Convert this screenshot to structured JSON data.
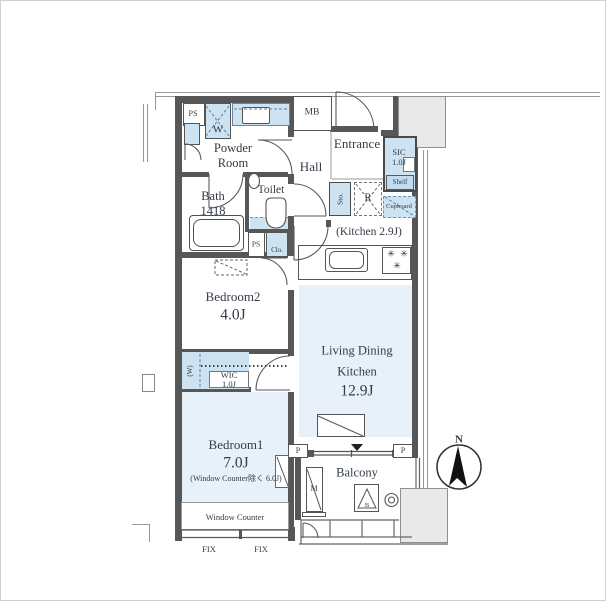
{
  "plan": {
    "compass": "N",
    "labels": {
      "ps_top": "PS",
      "washer": "W",
      "powder_room": "Powder Room",
      "meter_box": "MB",
      "entrance": "Entrance",
      "sic": "SIC 1.0J",
      "shelf": "Shelf",
      "cupboard": "Cupboard",
      "hall": "Hall",
      "storage": "Sto.",
      "fridge": "R",
      "bath": "Bath 1418",
      "toilet": "Toilet",
      "kitchen": "(Kitchen 2.9J)",
      "ps_mid": "PS",
      "closet": "Clo.",
      "bedroom2": "Bedroom2",
      "bedroom2_size": "4.0J",
      "wic_w": "(W)",
      "wic": "WIC 1.0J",
      "ldk_line1": "Living Dining",
      "ldk_line2": "Kitchen",
      "ldk_size": "12.9J",
      "bedroom1": "Bedroom1",
      "bedroom1_size": "7.0J",
      "bedroom1_note": "(Window Counter除く 6.0J)",
      "window_counter": "Window Counter",
      "fix_left": "FIX",
      "fix_right": "FIX",
      "pillar_left": "P",
      "pillar_right": "P",
      "balcony": "Balcony",
      "m_unit": "M",
      "b_hatch": "B"
    },
    "icons": {
      "burner": "✳"
    },
    "colors": {
      "fixture_blue": "#cde3f2",
      "room_blue": "#e8f1f9",
      "wall_gray": "#575757",
      "text": "#333c47"
    }
  }
}
